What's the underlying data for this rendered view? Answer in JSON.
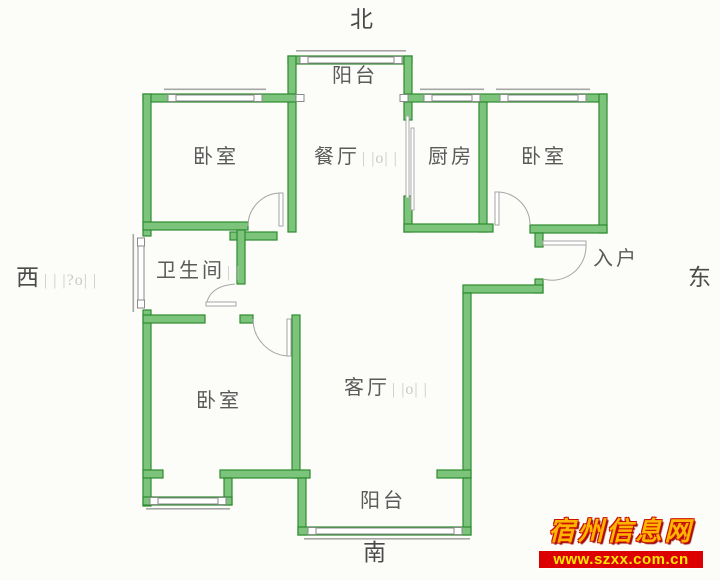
{
  "compass": {
    "north": "北",
    "south": "南",
    "west": "西",
    "east": "东"
  },
  "rooms": {
    "balcony_top": "阳台",
    "bedroom_nw": "卧室",
    "dining": "餐厅",
    "kitchen": "厨房",
    "bedroom_ne": "卧室",
    "bathroom": "卫生间",
    "entry": "入户",
    "bedroom_sw": "卧室",
    "living": "客厅",
    "balcony_bottom": "阳台"
  },
  "marks": {
    "dining": "| |o| |",
    "living": "| |o| |",
    "bathroom": "| |",
    "west": "| | |?o| |"
  },
  "watermark": {
    "site_name": "宿州信息网",
    "url": "www.szxx.com.cn"
  },
  "colors": {
    "bg": "#fcfcf9",
    "wall_fill": "#7cc47c",
    "wall_stroke": "#2e8b2e",
    "frame": "#8a8a8a",
    "door": "#a5a5a5",
    "label": "#5a5a5a",
    "mark": "#c9c9c9",
    "wm_title": "#ffb400",
    "wm_outline": "#cc1100",
    "wm_bar": "#dd0000",
    "wm_url": "#ffe600"
  }
}
